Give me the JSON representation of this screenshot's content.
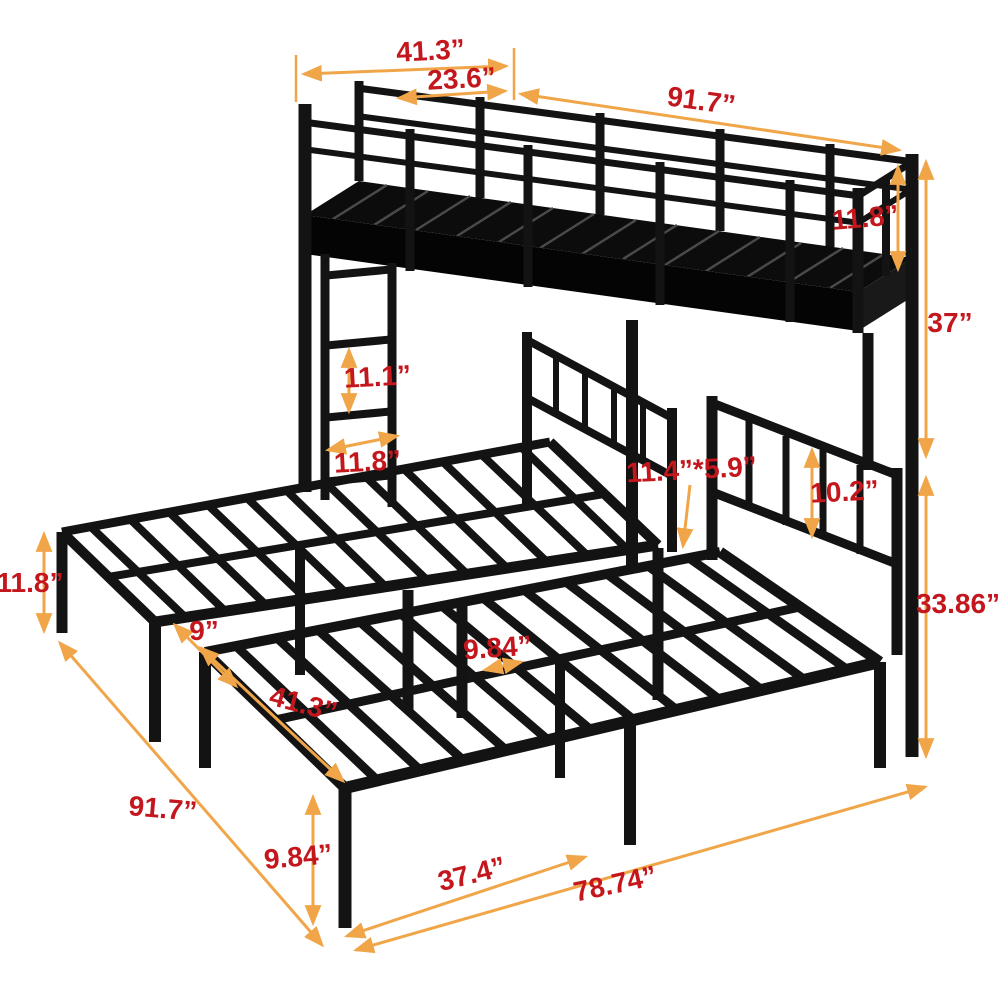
{
  "meta": {
    "subject": "metal triple bunk bed dimension diagram",
    "unit": "inches",
    "colors": {
      "frame": "#131313",
      "dimension_arrow": "#f0a648",
      "dimension_label": "#c4161d",
      "background": "#ffffff"
    }
  },
  "dims": {
    "top_bed_width": "41.3”",
    "top_rail_section": "23.6”",
    "top_bed_length": "91.7”",
    "guardrail_height": "11.8”",
    "under_bunk_clearance": "37”",
    "ladder_rung_spacing": "11.1”",
    "ladder_width": "11.8”",
    "support_post_size": "11.4”*5.9”",
    "headboard_rail_gap": "10.2”",
    "left_leg_height": "11.8”",
    "bed_gap": "9”",
    "lower_bed_length": "91.7”",
    "slat_spacing": "9.84”",
    "lower_bed_width": "41.3”",
    "front_leg_height": "9.84”",
    "front_bed_span": "37.4”",
    "total_front_span": "78.74”",
    "lower_bed_height": "33.86”"
  }
}
